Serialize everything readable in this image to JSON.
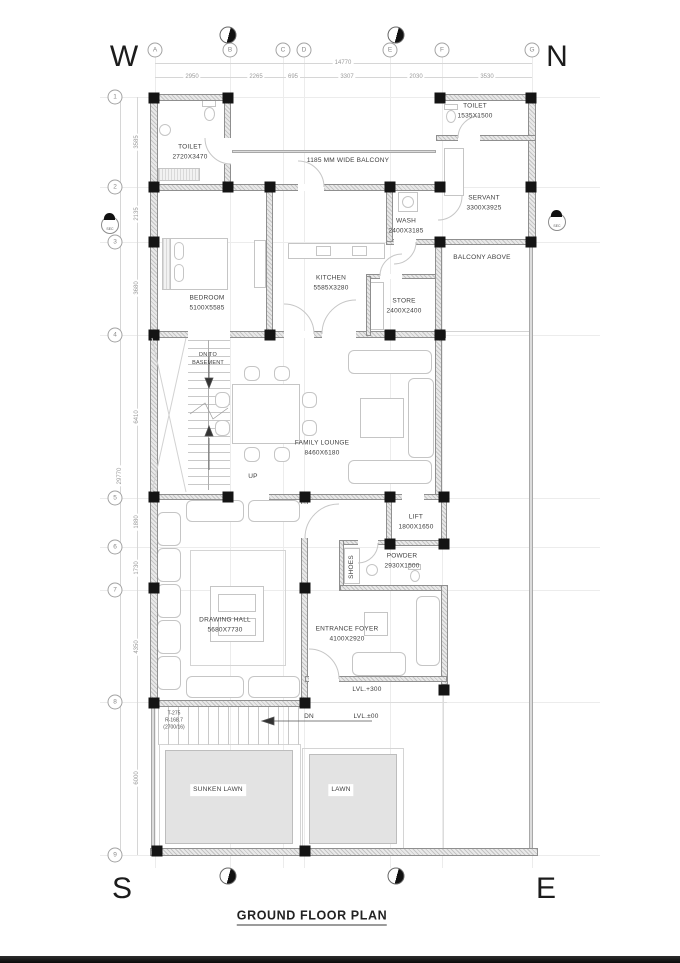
{
  "title": "GROUND FLOOR PLAN",
  "compass": {
    "w": "W",
    "n": "N",
    "s": "S",
    "e": "E"
  },
  "grid": {
    "cols": [
      "A",
      "B",
      "C",
      "D",
      "E",
      "F",
      "G"
    ],
    "rows": [
      "1",
      "2",
      "3",
      "4",
      "5",
      "6",
      "7",
      "8",
      "9"
    ]
  },
  "dims": {
    "top_overall": "14770",
    "top_segments": [
      "2950",
      "2265",
      "695",
      "3307",
      "2030",
      "3530"
    ],
    "left_overall": "29770",
    "left_segments": [
      "3585",
      "2135",
      "3680",
      "6410",
      "1880",
      "1730",
      "4350",
      "6000"
    ]
  },
  "rooms": {
    "toilet1": {
      "name": "TOILET",
      "size": "2720X3470"
    },
    "toilet2": {
      "name": "TOILET",
      "size": "1535X1500"
    },
    "servant": {
      "name": "SERVANT",
      "size": "3300X3925"
    },
    "wash": {
      "name": "WASH",
      "size": "2400X3185"
    },
    "kitchen": {
      "name": "KITCHEN",
      "size": "5585X3280"
    },
    "store": {
      "name": "STORE",
      "size": "2400X2400"
    },
    "bedroom": {
      "name": "BEDROOM",
      "size": "5100X5585"
    },
    "family_lounge": {
      "name": "FAMILY LOUNGE",
      "size": "8460X6180"
    },
    "lift": {
      "name": "LIFT",
      "size": "1800X1650"
    },
    "powder": {
      "name": "POWDER",
      "size": "2930X1500"
    },
    "drawing_hall": {
      "name": "DRAWING HALL",
      "size": "5680X7730"
    },
    "entrance_foyer": {
      "name": "ENTRANCE FOYER",
      "size": "4100X2920"
    }
  },
  "annotations": {
    "balcony": "1185 MM WIDE BALCONY",
    "balcony_above": "BALCONY ABOVE",
    "dn_to": "DN TO",
    "basement": "BASEMENT",
    "up": "UP",
    "dn": "DN",
    "shoes": "SHOES",
    "lvl_entrance": "LVL.+300",
    "lvl_ground": "LVL.±00",
    "stair_tread": "T-275",
    "stair_riser": "R-168.7",
    "stair_count": "(2700/16)",
    "sunken_lawn": "SUNKEN LAWN",
    "lawn": "LAWN",
    "sec": "SEC"
  }
}
